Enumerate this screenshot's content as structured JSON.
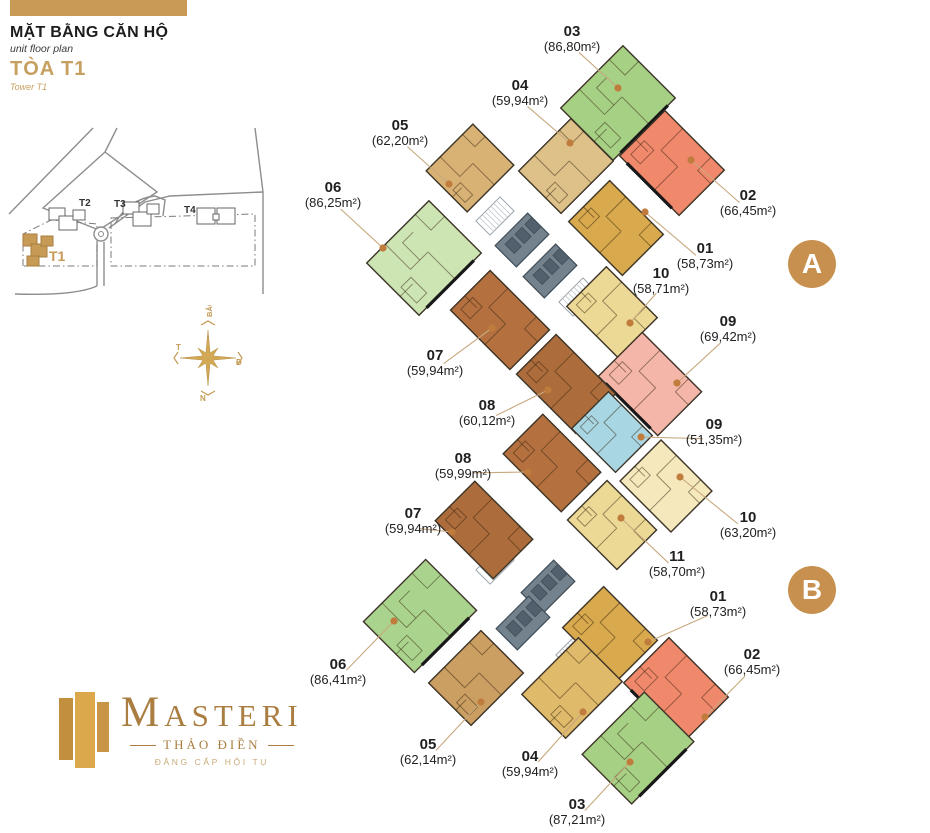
{
  "header": {
    "title": "MẶT BẰNG CĂN HỘ",
    "subtitle": "unit floor plan",
    "tower": "TÒA T1",
    "tower_en": "Tower T1"
  },
  "site_map": {
    "buildings": [
      "T2",
      "T3",
      "T4"
    ],
    "highlight": "T1"
  },
  "compass": {
    "north": "BẮC",
    "south": "N",
    "west": "T",
    "east": "Đ"
  },
  "logo": {
    "brand": "MASTERI",
    "location": "THẢO ĐIỀN",
    "tagline": "ĐẲNG CẤP HỘI TỤ"
  },
  "badges": [
    {
      "label": "A",
      "x": 812,
      "y": 264
    },
    {
      "label": "B",
      "x": 812,
      "y": 590
    }
  ],
  "colors": {
    "accent_tan": "#c89a55",
    "badge": "#c8904f",
    "leader": "#c8a87e",
    "dot": "#c07c3c",
    "wall": "#3d3427",
    "core_gray": "#74828e",
    "label_text": "#1f1f1f"
  },
  "floor_plan": {
    "units": [
      {
        "id": "A-05",
        "number": "05",
        "area": "(62,20m²)",
        "fill": "#d8b175",
        "cx": 470,
        "cy": 168,
        "w": 66,
        "h": 58,
        "rot": -45,
        "label": {
          "x": 400,
          "y": 124
        },
        "dot": {
          "x": 449,
          "y": 184
        },
        "balcony": false
      },
      {
        "id": "A-04",
        "number": "04",
        "area": "(59,94m²)",
        "fill": "#ddc189",
        "cx": 566,
        "cy": 166,
        "w": 74,
        "h": 60,
        "rot": -45,
        "label": {
          "x": 520,
          "y": 84
        },
        "dot": {
          "x": 570,
          "y": 143
        },
        "balcony": false
      },
      {
        "id": "A-03",
        "number": "03",
        "area": "(86,80m²)",
        "fill": "#a6d185",
        "cx": 618,
        "cy": 103,
        "w": 88,
        "h": 74,
        "rot": -45,
        "label": {
          "x": 572,
          "y": 30
        },
        "dot": {
          "x": 618,
          "y": 88
        },
        "balcony": true
      },
      {
        "id": "A-02",
        "number": "02",
        "area": "(66,45m²)",
        "fill": "#f0886c",
        "cx": 672,
        "cy": 163,
        "w": 84,
        "h": 64,
        "rot": 45,
        "label": {
          "x": 748,
          "y": 194
        },
        "dot": {
          "x": 691,
          "y": 160
        },
        "balcony": true
      },
      {
        "id": "A-01",
        "number": "01",
        "area": "(58,73m²)",
        "fill": "#d9a94e",
        "cx": 616,
        "cy": 228,
        "w": 76,
        "h": 58,
        "rot": 45,
        "label": {
          "x": 705,
          "y": 247
        },
        "dot": {
          "x": 645,
          "y": 212
        },
        "balcony": false
      },
      {
        "id": "A-10",
        "number": "10",
        "area": "(58,71m²)",
        "fill": "#ebd995",
        "cx": 612,
        "cy": 312,
        "w": 72,
        "h": 56,
        "rot": 45,
        "label": {
          "x": 661,
          "y": 272
        },
        "dot": {
          "x": 630,
          "y": 323
        },
        "balcony": false
      },
      {
        "id": "A-09",
        "number": "09",
        "area": "(69,42m²)",
        "fill": "#f4b6a8",
        "cx": 650,
        "cy": 384,
        "w": 84,
        "h": 62,
        "rot": 45,
        "label": {
          "x": 728,
          "y": 320
        },
        "dot": {
          "x": 677,
          "y": 383
        },
        "balcony": true
      },
      {
        "id": "A-06",
        "number": "06",
        "area": "(86,25m²)",
        "fill": "#cde4b3",
        "cx": 424,
        "cy": 258,
        "w": 88,
        "h": 74,
        "rot": -45,
        "label": {
          "x": 333,
          "y": 186
        },
        "dot": {
          "x": 383,
          "y": 248
        },
        "balcony": true
      },
      {
        "id": "A-07",
        "number": "07",
        "area": "(59,94m²)",
        "fill": "#b4713f",
        "cx": 500,
        "cy": 320,
        "w": 84,
        "h": 56,
        "rot": 45,
        "label": {
          "x": 435,
          "y": 354
        },
        "dot": {
          "x": 492,
          "y": 328
        },
        "balcony": false
      },
      {
        "id": "A-08",
        "number": "08",
        "area": "(60,12m²)",
        "fill": "#ad6c3c",
        "cx": 566,
        "cy": 384,
        "w": 84,
        "h": 56,
        "rot": 45,
        "label": {
          "x": 487,
          "y": 404
        },
        "dot": {
          "x": 548,
          "y": 390
        },
        "balcony": false
      },
      {
        "id": "M-09",
        "number": "09",
        "area": "(51,35m²)",
        "fill": "#a9d6e3",
        "cx": 612,
        "cy": 432,
        "w": 62,
        "h": 52,
        "rot": 45,
        "label": {
          "x": 714,
          "y": 423
        },
        "dot": {
          "x": 641,
          "y": 437
        },
        "balcony": false
      },
      {
        "id": "M-10",
        "number": "10",
        "area": "(63,20m²)",
        "fill": "#f5e8bc",
        "cx": 666,
        "cy": 486,
        "w": 72,
        "h": 58,
        "rot": 45,
        "label": {
          "x": 748,
          "y": 516
        },
        "dot": {
          "x": 680,
          "y": 477
        },
        "balcony": false
      },
      {
        "id": "B-08",
        "number": "08",
        "area": "(59,99m²)",
        "fill": "#b4713f",
        "cx": 552,
        "cy": 463,
        "w": 82,
        "h": 56,
        "rot": 45,
        "label": {
          "x": 463,
          "y": 457
        },
        "dot": {
          "x": 528,
          "y": 472
        },
        "balcony": false
      },
      {
        "id": "B-07",
        "number": "07",
        "area": "(59,94m²)",
        "fill": "#ad6c3c",
        "cx": 484,
        "cy": 530,
        "w": 82,
        "h": 56,
        "rot": 45,
        "label": {
          "x": 413,
          "y": 512
        },
        "dot": {
          "x": 452,
          "y": 532
        },
        "balcony": false
      },
      {
        "id": "B-11",
        "number": "11",
        "area": "(58,70m²)",
        "fill": "#ebd995",
        "cx": 612,
        "cy": 525,
        "w": 70,
        "h": 56,
        "rot": 45,
        "label": {
          "x": 677,
          "y": 555
        },
        "dot": {
          "x": 621,
          "y": 518
        },
        "balcony": false
      },
      {
        "id": "B-01",
        "number": "01",
        "area": "(58,73m²)",
        "fill": "#d9a94e",
        "cx": 610,
        "cy": 634,
        "w": 76,
        "h": 58,
        "rot": 45,
        "label": {
          "x": 718,
          "y": 595
        },
        "dot": {
          "x": 648,
          "y": 642
        },
        "balcony": false
      },
      {
        "id": "B-02",
        "number": "02",
        "area": "(66,45m²)",
        "fill": "#f0886c",
        "cx": 676,
        "cy": 690,
        "w": 84,
        "h": 64,
        "rot": 45,
        "label": {
          "x": 752,
          "y": 653
        },
        "dot": {
          "x": 705,
          "y": 717
        },
        "balcony": true
      },
      {
        "id": "B-06",
        "number": "06",
        "area": "(86,41m²)",
        "fill": "#aad48d",
        "cx": 420,
        "cy": 616,
        "w": 88,
        "h": 72,
        "rot": -45,
        "label": {
          "x": 338,
          "y": 663
        },
        "dot": {
          "x": 394,
          "y": 621
        },
        "balcony": true
      },
      {
        "id": "B-05",
        "number": "05",
        "area": "(62,14m²)",
        "fill": "#cb9e62",
        "cx": 476,
        "cy": 678,
        "w": 74,
        "h": 60,
        "rot": -45,
        "label": {
          "x": 428,
          "y": 743
        },
        "dot": {
          "x": 481,
          "y": 702
        },
        "balcony": false
      },
      {
        "id": "B-04",
        "number": "04",
        "area": "(59,94m²)",
        "fill": "#dfba6b",
        "cx": 572,
        "cy": 688,
        "w": 80,
        "h": 62,
        "rot": -45,
        "label": {
          "x": 530,
          "y": 755
        },
        "dot": {
          "x": 583,
          "y": 712
        },
        "balcony": false
      },
      {
        "id": "B-03",
        "number": "03",
        "area": "(87,21m²)",
        "fill": "#a6d185",
        "cx": 638,
        "cy": 748,
        "w": 88,
        "h": 70,
        "rot": -45,
        "label": {
          "x": 577,
          "y": 803
        },
        "dot": {
          "x": 630,
          "y": 762
        },
        "balcony": true
      }
    ],
    "cores": [
      {
        "cx": 522,
        "cy": 240
      },
      {
        "cx": 550,
        "cy": 271
      },
      {
        "cx": 548,
        "cy": 587
      },
      {
        "cx": 523,
        "cy": 623
      }
    ],
    "stairs": [
      {
        "cx": 495,
        "cy": 216
      },
      {
        "cx": 578,
        "cy": 297
      },
      {
        "cx": 495,
        "cy": 565
      },
      {
        "cx": 575,
        "cy": 650
      }
    ]
  }
}
